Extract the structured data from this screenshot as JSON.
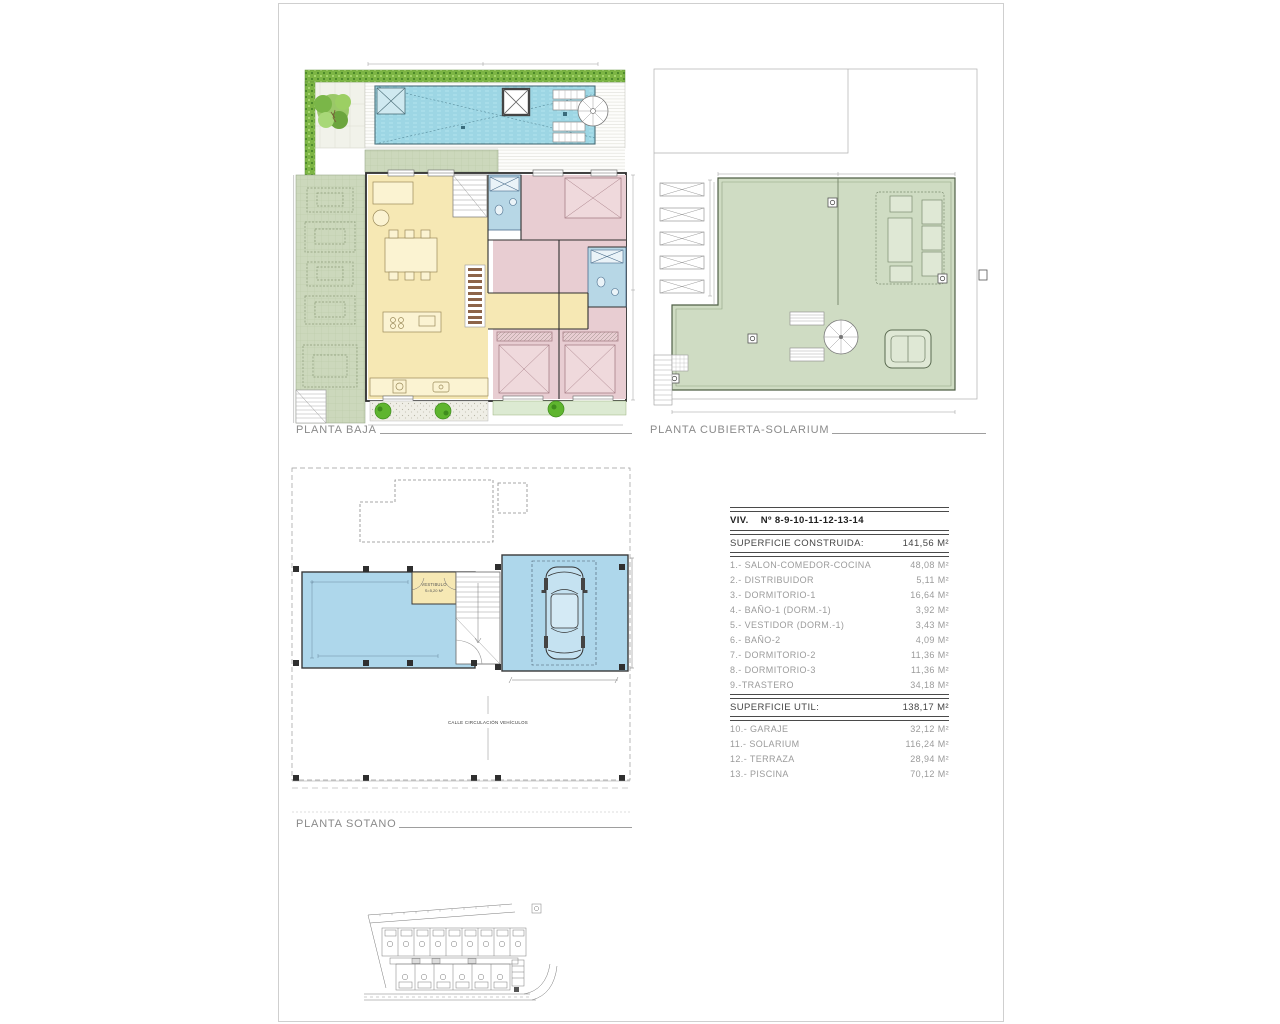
{
  "plans": {
    "baja": {
      "label": "PLANTA BAJA"
    },
    "cubierta": {
      "label": "PLANTA CUBIERTA-SOLARIUM"
    },
    "sotano": {
      "label": "PLANTA SOTANO"
    }
  },
  "annotations": {
    "vestibulo_line1": "VESTIBULO",
    "vestibulo_line2": "S=5,20 M²",
    "calle": "CALLE CIRCULACIÓN VEHÍCULOS"
  },
  "table": {
    "unit_header": {
      "label": "VIV.",
      "value": "Nº 8-9-10-11-12-13-14"
    },
    "constructed": {
      "label": "SUPERFICIE CONSTRUIDA:",
      "value": "141,56 M²"
    },
    "rooms": [
      {
        "label": "1.- SALON-COMEDOR-COCINA",
        "value": "48,08 M²"
      },
      {
        "label": "2.- DISTRIBUIDOR",
        "value": "5,11 M²"
      },
      {
        "label": "3.- DORMITORIO-1",
        "value": "16,64 M²"
      },
      {
        "label": "4.- BAÑO-1 (DORM.-1)",
        "value": "3,92 M²"
      },
      {
        "label": "5.- VESTIDOR (DORM.-1)",
        "value": "3,43 M²"
      },
      {
        "label": "6.- BAÑO-2",
        "value": "4,09 M²"
      },
      {
        "label": "7.- DORMITORIO-2",
        "value": "11,36 M²"
      },
      {
        "label": "8.- DORMITORIO-3",
        "value": "11,36 M²"
      },
      {
        "label": "9.-TRASTERO",
        "value": "34,18 M²"
      }
    ],
    "useful": {
      "label": "SUPERFICIE UTIL:",
      "value": "138,17 M²"
    },
    "exterior": [
      {
        "label": "10.- GARAJE",
        "value": "32,12 M²"
      },
      {
        "label": "11.- SOLARIUM",
        "value": "116,24 M²"
      },
      {
        "label": "12.- TERRAZA",
        "value": "28,94 M²"
      },
      {
        "label": "13.- PISCINA",
        "value": "70,12 M²"
      }
    ]
  },
  "colors": {
    "hedge_green": "#7cb544",
    "garden_sage": "#ccd8bc",
    "solarium_green": "#cfdcc3",
    "pool_blue": "#a8dde9",
    "interior_yellow": "#f6e8b4",
    "bedroom_pink": "#e8cdd2",
    "bath_blue": "#b7d7e6",
    "basement_blue": "#aed7eb",
    "bush_green": "#5fb52f"
  }
}
